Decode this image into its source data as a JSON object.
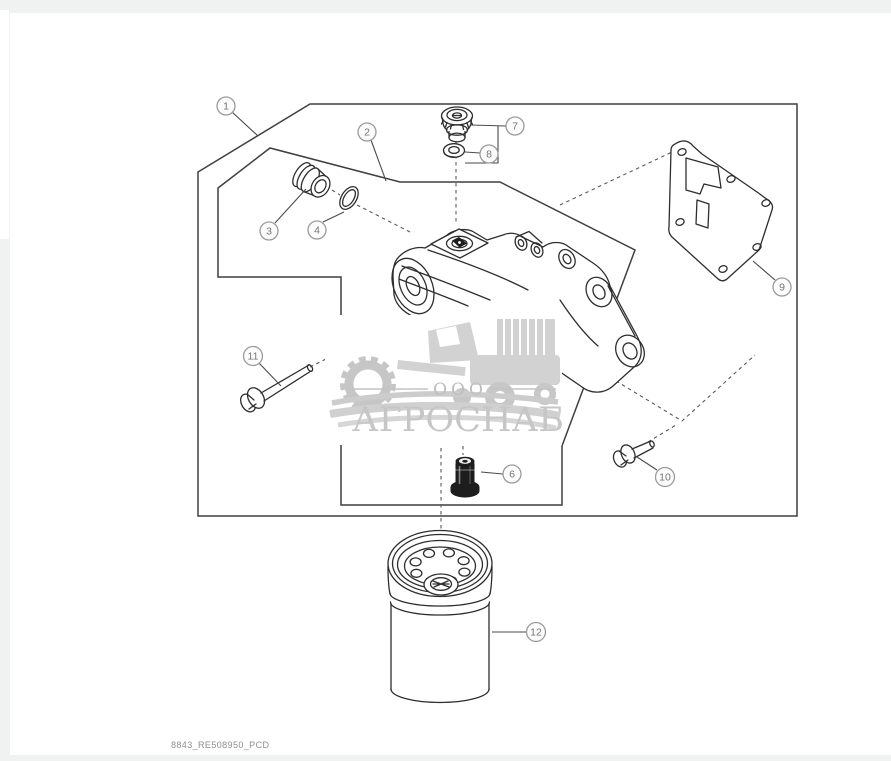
{
  "window": {
    "background_color": "#f0f1f1",
    "page_color": "#ffffff"
  },
  "diagram": {
    "kind": "exploded-parts-view",
    "line_color": "#2e2e2e",
    "callout_border_color": "#9b9b9b",
    "callout_text_color": "#757575",
    "callouts": [
      "1",
      "2",
      "3",
      "4",
      "6",
      "7",
      "8",
      "9",
      "10",
      "11",
      "12"
    ]
  },
  "watermark": {
    "prefix": "ООО",
    "name": "АГРОСНАБ",
    "color": "#c6c6c6"
  },
  "footer": {
    "image_code": "8843_RE508950_PCD"
  }
}
